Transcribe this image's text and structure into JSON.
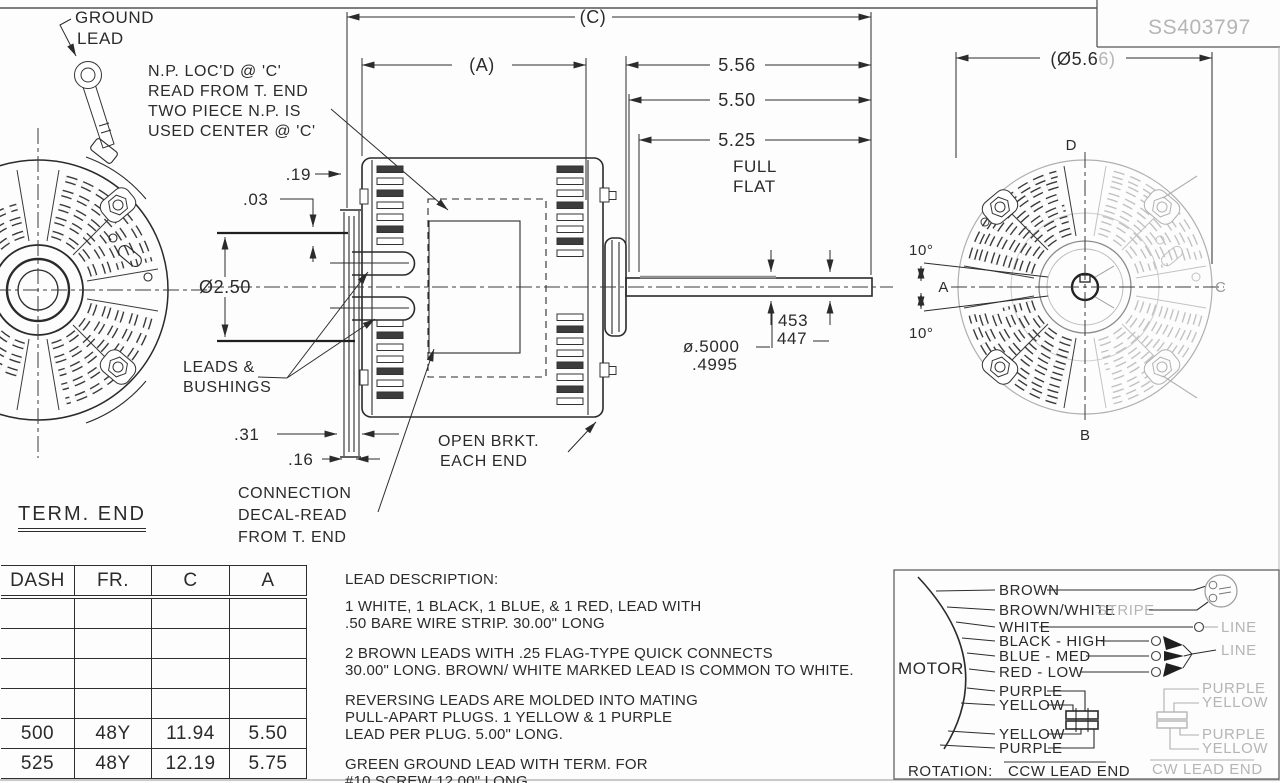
{
  "sheet": {
    "part_number": "SS403797"
  },
  "views": {
    "term_end_label": "TERM. END",
    "axis": {
      "a": "A",
      "b": "B",
      "c": "C",
      "d": "D"
    }
  },
  "annotations": {
    "ground_lead": [
      "GROUND",
      "LEAD"
    ],
    "np_note": [
      "N.P. LOC'D @ 'C'",
      "READ FROM T. END",
      "TWO PIECE N.P. IS",
      "USED CENTER @ 'C'"
    ],
    "leads_bushings": [
      "LEADS &",
      "BUSHINGS"
    ],
    "open_bracket": [
      "OPEN BRKT.",
      "EACH END"
    ],
    "connection_decal": [
      "CONNECTION",
      "DECAL-READ",
      "FROM T. END"
    ]
  },
  "dimensions": {
    "c_ref": "(C)",
    "a_ref": "(A)",
    "d556": "5.56",
    "d550": "5.50",
    "d525": "5.25",
    "full_flat": [
      "FULL",
      "FLAT"
    ],
    "d19": ".19",
    "d03": ".03",
    "dia250": "Ø2.50",
    "d31": ".31",
    "d16": ".16",
    "shaft_dia": [
      "ø.5000",
      ".4995"
    ],
    "flat_depth": [
      "453",
      "447"
    ],
    "dia566_main": "(Ø5.6",
    "dia566_faded": "6)",
    "angle_top": "10°",
    "angle_bottom": "10°"
  },
  "table": {
    "headers": [
      "DASH",
      "FR.",
      "C",
      "A"
    ],
    "rows": [
      [
        "",
        "",
        "",
        ""
      ],
      [
        "",
        "",
        "",
        ""
      ],
      [
        "",
        "",
        "",
        ""
      ],
      [
        "",
        "",
        "",
        ""
      ],
      [
        "500",
        "48Y",
        "11.94",
        "5.50"
      ],
      [
        "525",
        "48Y",
        "12.19",
        "5.75"
      ]
    ]
  },
  "lead_description": {
    "title": "LEAD DESCRIPTION:",
    "paragraphs": [
      [
        "1 WHITE, 1 BLACK, 1 BLUE, & 1 RED, LEAD WITH",
        ".50 BARE WIRE STRIP. 30.00\" LONG"
      ],
      [
        "2 BROWN LEADS WITH .25 FLAG-TYPE QUICK CONNECTS",
        "30.00\" LONG. BROWN/ WHITE MARKED LEAD IS COMMON TO WHITE."
      ],
      [
        "REVERSING LEADS ARE MOLDED INTO MATING",
        "PULL-APART PLUGS. 1 YELLOW & 1 PURPLE",
        "LEAD PER PLUG. 5.00\" LONG."
      ],
      [
        "GREEN GROUND LEAD WITH TERM. FOR",
        "#10 SCREW 12.00\" LONG."
      ]
    ]
  },
  "wiring": {
    "motor_label": "MOTOR",
    "leads": [
      "BROWN",
      "BROWN/WHITE",
      "WHITE",
      "BLACK - HIGH",
      "BLUE - MED",
      "RED - LOW",
      "PURPLE",
      "YELLOW",
      "YELLOW",
      "PURPLE"
    ],
    "stripe_label": "STRIPE",
    "line_labels": [
      "LINE",
      "LINE"
    ],
    "cw_leads": [
      "PURPLE",
      "YELLOW",
      "PURPLE",
      "YELLOW"
    ],
    "rotation_label": "ROTATION:",
    "ccw": "CCW LEAD END",
    "cw": "CW LEAD END"
  },
  "colors": {
    "ink": "#2b2b2b",
    "faded": "#b5b5b5",
    "paper": "#fdfdfd"
  }
}
